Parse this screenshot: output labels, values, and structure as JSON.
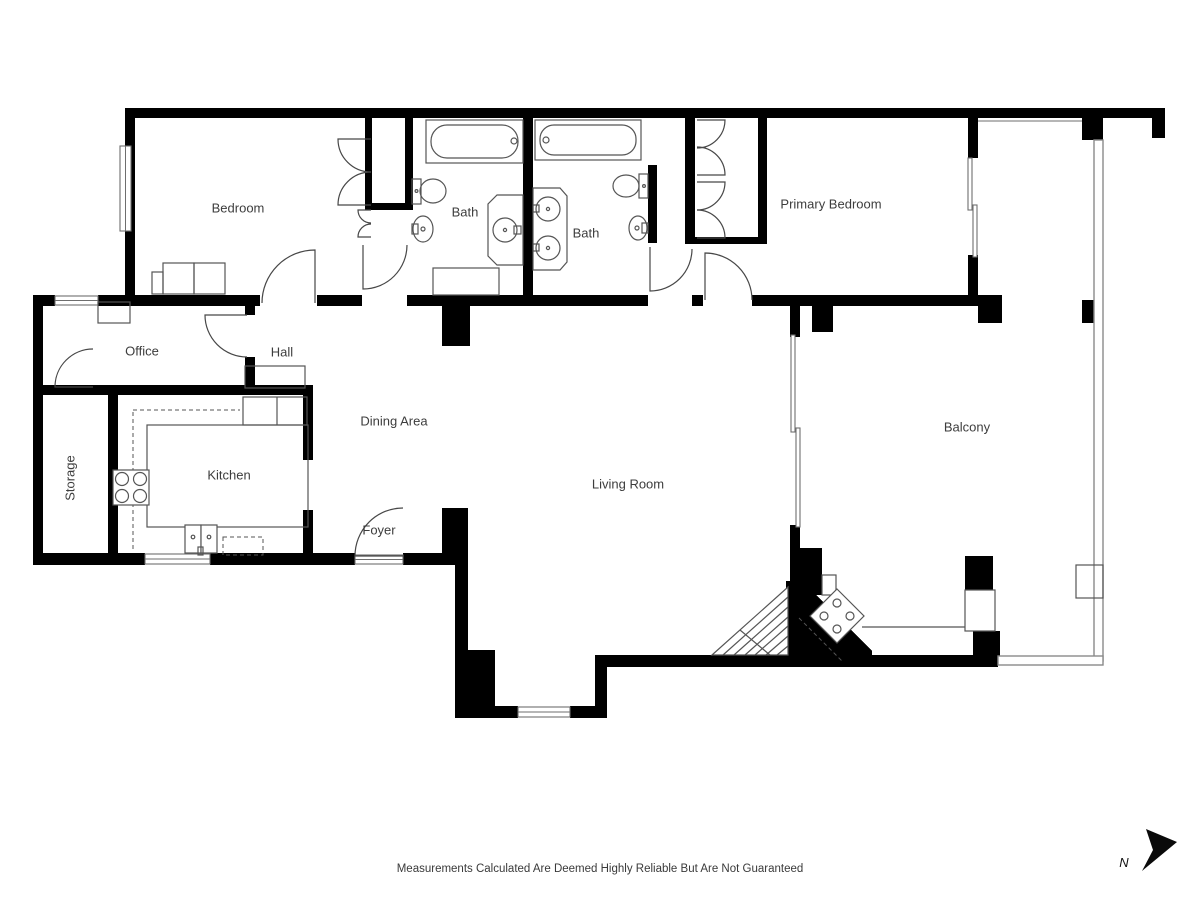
{
  "rooms": {
    "bedroom": {
      "label": "Bedroom"
    },
    "bath1": {
      "label": "Bath"
    },
    "bath2": {
      "label": "Bath"
    },
    "primary": {
      "label": "Primary Bedroom"
    },
    "office": {
      "label": "Office"
    },
    "hall": {
      "label": "Hall"
    },
    "storage": {
      "label": "Storage"
    },
    "kitchen": {
      "label": "Kitchen"
    },
    "dining": {
      "label": "Dining Area"
    },
    "foyer": {
      "label": "Foyer"
    },
    "living": {
      "label": "Living Room"
    },
    "balcony": {
      "label": "Balcony"
    }
  },
  "footer": {
    "disclaimer": "Measurements Calculated Are Deemed Highly Reliable But Are Not Guaranteed"
  },
  "compass": {
    "north_label": "N"
  },
  "colors": {
    "wall": "#000000",
    "fixture_line": "#555555",
    "rail_line": "#8a8a8a",
    "label_text": "#3d3d3d",
    "background": "#ffffff"
  }
}
